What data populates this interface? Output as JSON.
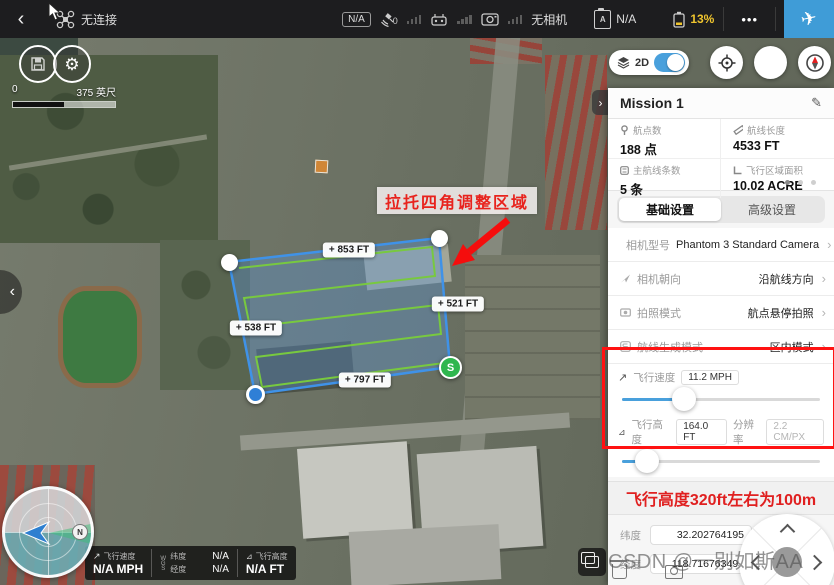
{
  "colors": {
    "accent_blue": "#49a0dc",
    "battery_warning": "#f0c52e",
    "annotation_red": "#e8231d",
    "polygon_blue": "#3f92e8",
    "route_green": "#78c93f"
  },
  "icons": {
    "back": "‹",
    "chevron_right": "›",
    "collapse": "›",
    "expand": "‹",
    "pencil": "✎",
    "more": "•••",
    "gear": "⚙",
    "plane": "✈",
    "speed_arrow": "↗",
    "alt_arrow": "⛛"
  },
  "topbar": {
    "connection_status": "无连接",
    "gps_mode_badge": "N/A",
    "satellite_count": "0",
    "camera_status": "无相机",
    "flight_mode_value": "N/A",
    "battery_level": "13%"
  },
  "map": {
    "scale_start": "0",
    "scale_end": "375 英尺",
    "view_mode": "2D",
    "annotation": "拉托四角调整区域",
    "edge_labels": [
      "+ 853 FT",
      "+ 521 FT",
      "+ 538 FT",
      "+ 797 FT"
    ],
    "start_marker": "S",
    "compass_north": "N"
  },
  "panel": {
    "title": "Mission 1",
    "stats": [
      {
        "label": "航点数",
        "value": "188 点"
      },
      {
        "label": "航线长度",
        "value": "4533 FT"
      },
      {
        "label": "主航线条数",
        "value": "5 条"
      },
      {
        "label": "飞行区域面积",
        "value": "10.02 ACRE"
      }
    ],
    "tabs": [
      {
        "label": "基础设置"
      },
      {
        "label": "高级设置"
      }
    ],
    "settings": [
      {
        "label": "相机型号",
        "value": "Phantom 3 Standard Camera"
      },
      {
        "label": "相机朝向",
        "value": "沿航线方向"
      },
      {
        "label": "拍照模式",
        "value": "航点悬停拍照"
      },
      {
        "label": "航线生成模式",
        "value": "区内模式"
      }
    ],
    "speed": {
      "label": "飞行速度",
      "value": "11.2 MPH"
    },
    "altitude": {
      "label": "飞行高度",
      "value": "164.0 FT",
      "res_label": "分辨率",
      "res_value": "2.2 CM/PX"
    },
    "note": "飞行高度320ft左右为100m",
    "coords": {
      "lat_label": "纬度",
      "lat_value": "32.202764195",
      "lng_label": "经度",
      "lng_value": "118.716763493"
    }
  },
  "telemetry": {
    "speed_label": "飞行速度",
    "speed_value": "N/A MPH",
    "datum": "WGS",
    "lat_label": "纬度",
    "lat_value": "N/A",
    "lng_label": "经度",
    "lng_value": "N/A",
    "alt_label": "飞行高度",
    "alt_value": "N/A FT"
  },
  "watermark": "CSDN @一别如斯AA"
}
